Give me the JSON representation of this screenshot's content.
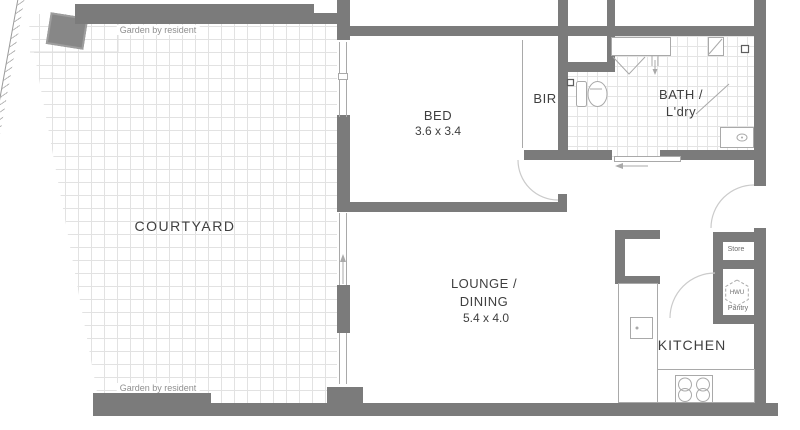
{
  "plan": {
    "courtyard": {
      "label": "COURTYARD"
    },
    "garden_top": {
      "label": "Garden by resident"
    },
    "garden_bottom": {
      "label": "Garden by resident"
    },
    "bed": {
      "label": "BED",
      "dims": "3.6 x 3.4"
    },
    "bir": {
      "label": "BIR"
    },
    "bath": {
      "line1": "BATH /",
      "line2": "L'dry"
    },
    "lounge": {
      "line1": "LOUNGE /",
      "line2": "DINING",
      "dims": "5.4 x 4.0"
    },
    "kitchen": {
      "label": "KITCHEN"
    },
    "store": {
      "label": "Store"
    },
    "hwu": {
      "label": "HWU"
    },
    "pantry": {
      "label": "Pantry"
    }
  },
  "colors": {
    "wall": "#7b7b7b",
    "tile-line": "#e2e2e2",
    "bath-tile-line": "#e4e4e4",
    "fixture": "#a9a9a9",
    "arc": "#cbcbcb",
    "text": "#3f3f3f",
    "muted-text": "#8f8f8f"
  }
}
